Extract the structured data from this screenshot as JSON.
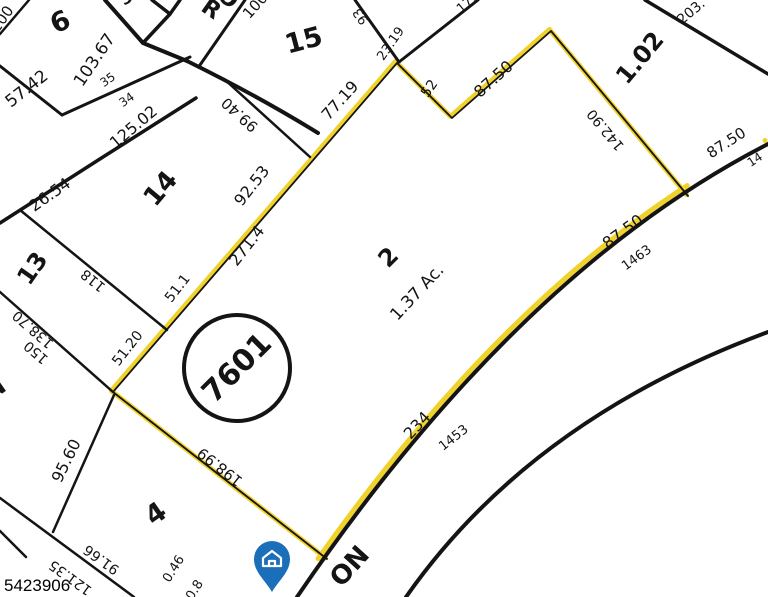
{
  "map": {
    "type": "tax-parcel-plat-map",
    "photo_id": "5423906",
    "block_circle_number": "7601",
    "highlighted_parcel": {
      "lot_number": "2",
      "area_label": "1.37 Ac."
    },
    "adjacent_lot_numbers": [
      "6",
      "15",
      "14",
      "13",
      "4",
      "1.02",
      "3"
    ],
    "road_name_partials": {
      "top": "RO",
      "bottom": "ON"
    },
    "house_address_numbers": [
      "1463",
      "1453"
    ],
    "colors": {
      "highlight": "#F0D22B",
      "line": "#141414",
      "house_pin": "#1B6FBA"
    }
  },
  "map_labels": [
    {
      "t": "100",
      "x": 6,
      "y": 22,
      "r": -55,
      "s": 15
    },
    {
      "t": "6",
      "x": 64,
      "y": 30,
      "r": -25,
      "s": 27,
      "b": 1
    },
    {
      "t": "57.42",
      "x": 30,
      "y": 93,
      "r": -38,
      "s": 17
    },
    {
      "t": "103.67",
      "x": 99,
      "y": 63,
      "r": -56,
      "s": 17
    },
    {
      "t": "35",
      "x": 110,
      "y": 83,
      "r": -35,
      "s": 12
    },
    {
      "t": "34",
      "x": 129,
      "y": 103,
      "r": -35,
      "s": 12
    },
    {
      "t": "125.02",
      "x": 137,
      "y": 131,
      "r": -40,
      "s": 16
    },
    {
      "t": "3",
      "x": 129,
      "y": 3,
      "r": -30,
      "s": 16,
      "b": 1
    },
    {
      "t": "R",
      "x": 207,
      "y": 15,
      "r": 35,
      "s": 23,
      "b": 1
    },
    {
      "t": "O",
      "x": 224,
      "y": 4,
      "r": 35,
      "s": 23,
      "b": 1
    },
    {
      "t": "100",
      "x": 259,
      "y": 9,
      "r": -48,
      "s": 15
    },
    {
      "t": "15",
      "x": 306,
      "y": 49,
      "r": -15,
      "s": 27,
      "b": 1
    },
    {
      "t": "99.40",
      "x": 243,
      "y": 111,
      "r": 222,
      "s": 15
    },
    {
      "t": "26.54",
      "x": 53,
      "y": 199,
      "r": -35,
      "s": 16
    },
    {
      "t": "14",
      "x": 167,
      "y": 194,
      "r": -50,
      "s": 26,
      "b": 1
    },
    {
      "t": "92.53",
      "x": 256,
      "y": 189,
      "r": -52,
      "s": 16
    },
    {
      "t": "271.4",
      "x": 251,
      "y": 249,
      "r": -52,
      "s": 16
    },
    {
      "t": "13",
      "x": 39,
      "y": 273,
      "r": -55,
      "s": 24,
      "b": 1
    },
    {
      "t": "118",
      "x": 96,
      "y": 277,
      "r": 219,
      "s": 14
    },
    {
      "t": "51.1",
      "x": 181,
      "y": 291,
      "r": -52,
      "s": 14
    },
    {
      "t": "51.20",
      "x": 131,
      "y": 351,
      "r": -52,
      "s": 14
    },
    {
      "t": "138.70",
      "x": 36,
      "y": 326,
      "r": 221,
      "s": 14
    },
    {
      "t": "150",
      "x": 39,
      "y": 349,
      "r": 221,
      "s": 14
    },
    {
      "t": "N",
      "x": 0,
      "y": 395,
      "r": -35,
      "s": 22,
      "b": 1
    },
    {
      "t": "95.60",
      "x": 71,
      "y": 463,
      "r": -64,
      "s": 16
    },
    {
      "t": "4",
      "x": 161,
      "y": 521,
      "r": -35,
      "s": 27,
      "b": 1
    },
    {
      "t": "91.66",
      "x": 104,
      "y": 556,
      "r": 216,
      "s": 14
    },
    {
      "t": "121.35",
      "x": 73,
      "y": 574,
      "r": 216,
      "s": 14
    },
    {
      "t": "0.46",
      "x": 177,
      "y": 571,
      "r": -58,
      "s": 13
    },
    {
      "t": "0.8",
      "x": 198,
      "y": 592,
      "r": -58,
      "s": 13
    },
    {
      "t": "198.99",
      "x": 223,
      "y": 463,
      "r": 218,
      "s": 15
    },
    {
      "t": "23.19",
      "x": 394,
      "y": 46,
      "r": -55,
      "s": 13
    },
    {
      "t": "93",
      "x": 364,
      "y": 14,
      "r": 235,
      "s": 13
    },
    {
      "t": "77.19",
      "x": 344,
      "y": 104,
      "r": -48,
      "s": 16
    },
    {
      "t": "52",
      "x": 433,
      "y": 91,
      "r": -55,
      "s": 14
    },
    {
      "t": "17.",
      "x": 469,
      "y": 7,
      "r": -40,
      "s": 13
    },
    {
      "t": "87.50",
      "x": 497,
      "y": 83,
      "r": -42,
      "s": 16
    },
    {
      "t": "1.02",
      "x": 646,
      "y": 63,
      "r": -50,
      "s": 24,
      "b": 1
    },
    {
      "t": "203.",
      "x": 694,
      "y": 15,
      "r": -40,
      "s": 14
    },
    {
      "t": "142.90",
      "x": 609,
      "y": 127,
      "r": 230,
      "s": 14
    },
    {
      "t": "87.50",
      "x": 729,
      "y": 147,
      "r": -33,
      "s": 15
    },
    {
      "t": "14",
      "x": 757,
      "y": 163,
      "r": -33,
      "s": 12
    },
    {
      "t": "2",
      "x": 394,
      "y": 263,
      "r": -45,
      "s": 24,
      "b": 1
    },
    {
      "t": "1.37 Ac.",
      "x": 421,
      "y": 296,
      "r": -47,
      "s": 17
    },
    {
      "t": "87.50",
      "x": 626,
      "y": 236,
      "r": -36,
      "s": 16
    },
    {
      "t": "1463",
      "x": 639,
      "y": 261,
      "r": -36,
      "s": 13
    },
    {
      "t": "234",
      "x": 421,
      "y": 429,
      "r": -47,
      "s": 16
    },
    {
      "t": "1453",
      "x": 456,
      "y": 441,
      "r": -38,
      "s": 13
    },
    {
      "t": "ON",
      "x": 356,
      "y": 572,
      "r": -48,
      "s": 26,
      "b": 1
    }
  ]
}
